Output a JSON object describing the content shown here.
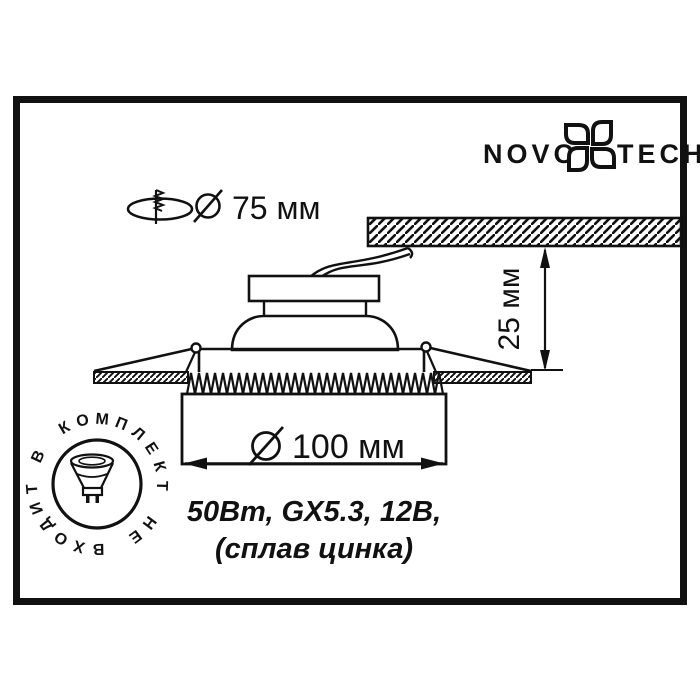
{
  "brand": {
    "name_left": "NOVO",
    "name_right": "TECH"
  },
  "dimensions": {
    "diameter_symbol": "Ø",
    "cutout_diameter": "75 мм",
    "visible_diameter": "100 мм",
    "recess_depth": "25 мм"
  },
  "specs": {
    "line1": "50Вт, GX5.3, 12В,",
    "line2": "(сплав цинка)"
  },
  "stamp": {
    "text": "В КОМПЛЕКТ НЕ ВХОДИТ"
  },
  "colors": {
    "ink": "#111111",
    "paper": "#ffffff"
  }
}
